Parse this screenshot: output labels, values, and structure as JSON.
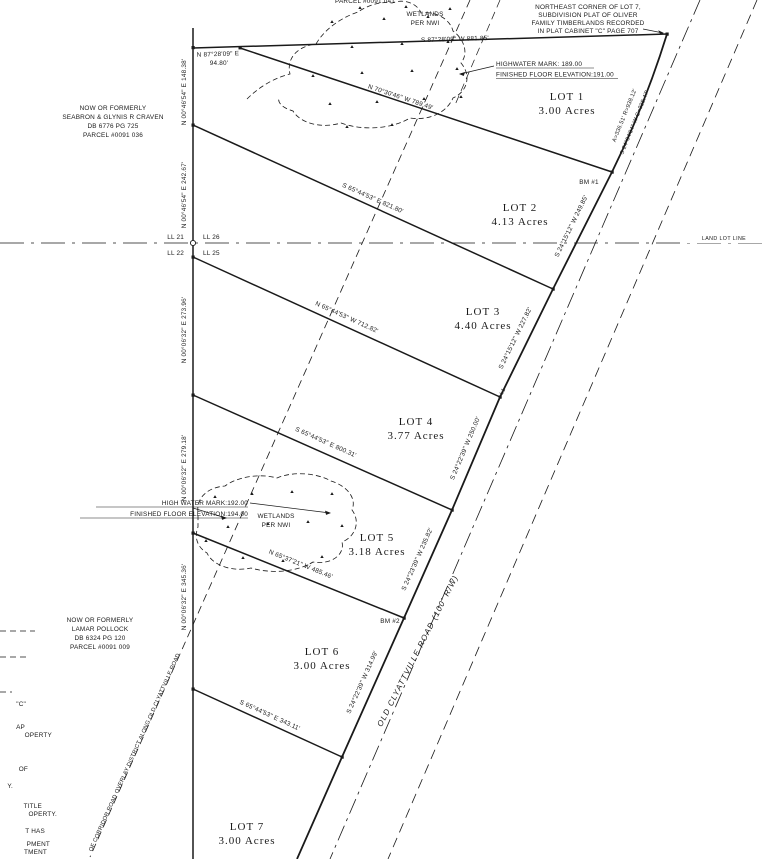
{
  "top": {
    "parcel_cut": "PARCEL #0091 041",
    "northeast_note": [
      "NORTHEAST CORNER OF LOT 7,",
      "SUBDIVISION PLAT OF OLIVER",
      "FAMILY TIMBERLANDS RECORDED",
      "IN PLAT CABINET \"C\" PAGE 707"
    ],
    "north_tie_bearing": "N 87°28'09\" E",
    "north_tie_dist": "94.80'",
    "north_line": "S 87°28'09\" W  881.85'"
  },
  "wetlands": {
    "line1": "WETLANDS",
    "line2": "PER NWI"
  },
  "flood": {
    "upper": [
      "HIGHWATER MARK: 189.00",
      "FINISHED FLOOR ELEVATION:191.00"
    ],
    "lower": [
      "HIGH WATER MARK:192.00",
      "FINISHED FLOOR ELEVATION:194.00"
    ]
  },
  "adjoiners": {
    "craven": [
      "NOW OR FORMERLY",
      "SEABRON & GLYNIS R CRAVEN",
      "DB 6776 PG 725",
      "PARCEL #0091 036"
    ],
    "pollock": [
      "NOW OR FORMERLY",
      "LAMAR POLLOCK",
      "DB 6324 PG 120",
      "PARCEL #0091 009"
    ]
  },
  "lots": [
    {
      "name": "LOT 1",
      "area": "3.00 Acres"
    },
    {
      "name": "LOT 2",
      "area": "4.13 Acres"
    },
    {
      "name": "LOT 3",
      "area": "4.40 Acres"
    },
    {
      "name": "LOT 4",
      "area": "3.77 Acres"
    },
    {
      "name": "LOT 5",
      "area": "3.18 Acres"
    },
    {
      "name": "LOT 6",
      "area": "3.00 Acres"
    },
    {
      "name": "LOT 7",
      "area": "3.00 Acres"
    }
  ],
  "lot_lines": [
    "N 70°30'46\" W  789.49'",
    "S 65°44'53\" E  821.80'",
    "N 65°44'53\" W  712.82'",
    "S 65°44'53\" E  800.31'",
    "N 65°37'21\" W  485.46'",
    "S 65°44'53\" E  343.11'"
  ],
  "west_line": [
    "N 00°46'54\" E  148.38'",
    "N 00°46'54\" E  242.67'",
    "N 00°06'32\" E  273.96'",
    "N 00°06'32\" E  279.18'",
    "N 00°06'32\" E  345.36'"
  ],
  "road": {
    "name": "OLD CLYATTVILLE ROAD (100' R/W)",
    "curve_arc": "A=336.51' R=938.12'",
    "curve_chord": "S 24°04'04\" W C=328.47'",
    "curve_tag": "L1",
    "segments": [
      "S 24°15'12\" W  249.85'",
      "S 24°15'12\" W  227.82'",
      "S 24°22'39\" W  250.00'",
      "S 24°23'39\" W  235.82'",
      "S 24°22'39\" W  314.99'"
    ]
  },
  "benchmarks": [
    "BM #1",
    "BM #2"
  ],
  "land_lot": {
    "nw": "LL 21",
    "ne": "LL 26",
    "sw": "LL 22",
    "se": "LL 25",
    "label": "LAND LOT LINE"
  },
  "corridor": "OF CORRIDOR ROAD OVERLAY DISTRICT ALONG OLD CLYATTVILLE ROAD",
  "edge_fragments": [
    "\"C\"",
    "AP",
    "OPERTY",
    "OF",
    "Y.",
    "TITLE",
    "OPERTY.",
    "T HAS",
    "PMENT",
    "TMENT"
  ]
}
